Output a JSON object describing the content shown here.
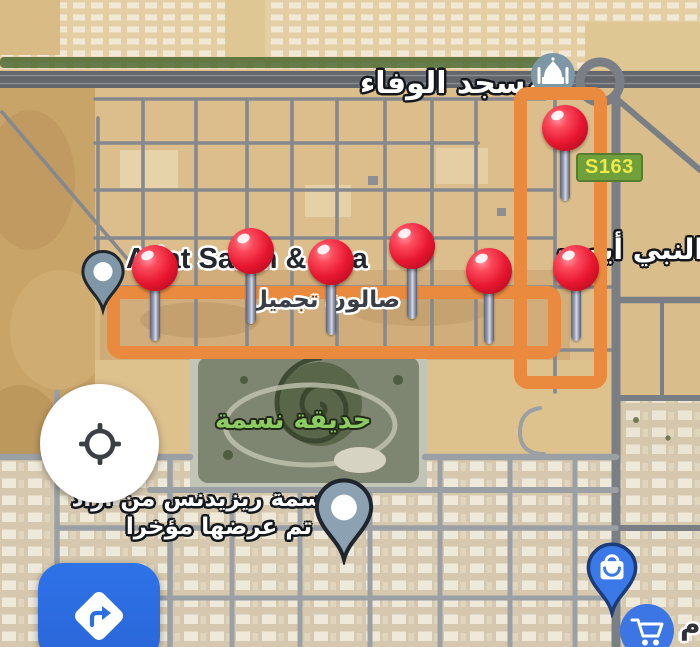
{
  "map": {
    "labels": {
      "mosque_name": "مسجد الوفاء",
      "street_name": "النبي أيوب",
      "route_badge": "S163",
      "salon_name_en": "Adat Salon & Spa",
      "salon_name_ar": "صالون تجميل",
      "park_name": "حديقة نسمة",
      "residence_name": "نسمة ريزيدنس من أراد",
      "residence_status": "تم عرضها مؤخرا",
      "corner_fragment": "م"
    },
    "red_pins": [
      {
        "x": 565,
        "y": 128
      },
      {
        "x": 155,
        "y": 268
      },
      {
        "x": 251,
        "y": 251
      },
      {
        "x": 331,
        "y": 262
      },
      {
        "x": 412,
        "y": 246
      },
      {
        "x": 489,
        "y": 271
      },
      {
        "x": 576,
        "y": 268
      }
    ],
    "poi_icons": {
      "mosque": "mosque-icon",
      "salon": "map-pin-icon",
      "residence": "map-pin-icon",
      "shopping": "shopping-bag-icon",
      "cart": "shopping-cart-icon"
    },
    "colors": {
      "selection_outline": "#EA8A3E",
      "pin_red": "#E81730",
      "poi_blue": "#3B76E4",
      "badge_bg": "#6FA03C",
      "badge_text": "#EFE94B",
      "park_label": "#8DCB63",
      "directions_button": "#2B6FE3"
    }
  },
  "controls": {
    "my_location_icon": "crosshair-icon",
    "directions_icon": "diamond-turn-right-icon"
  }
}
